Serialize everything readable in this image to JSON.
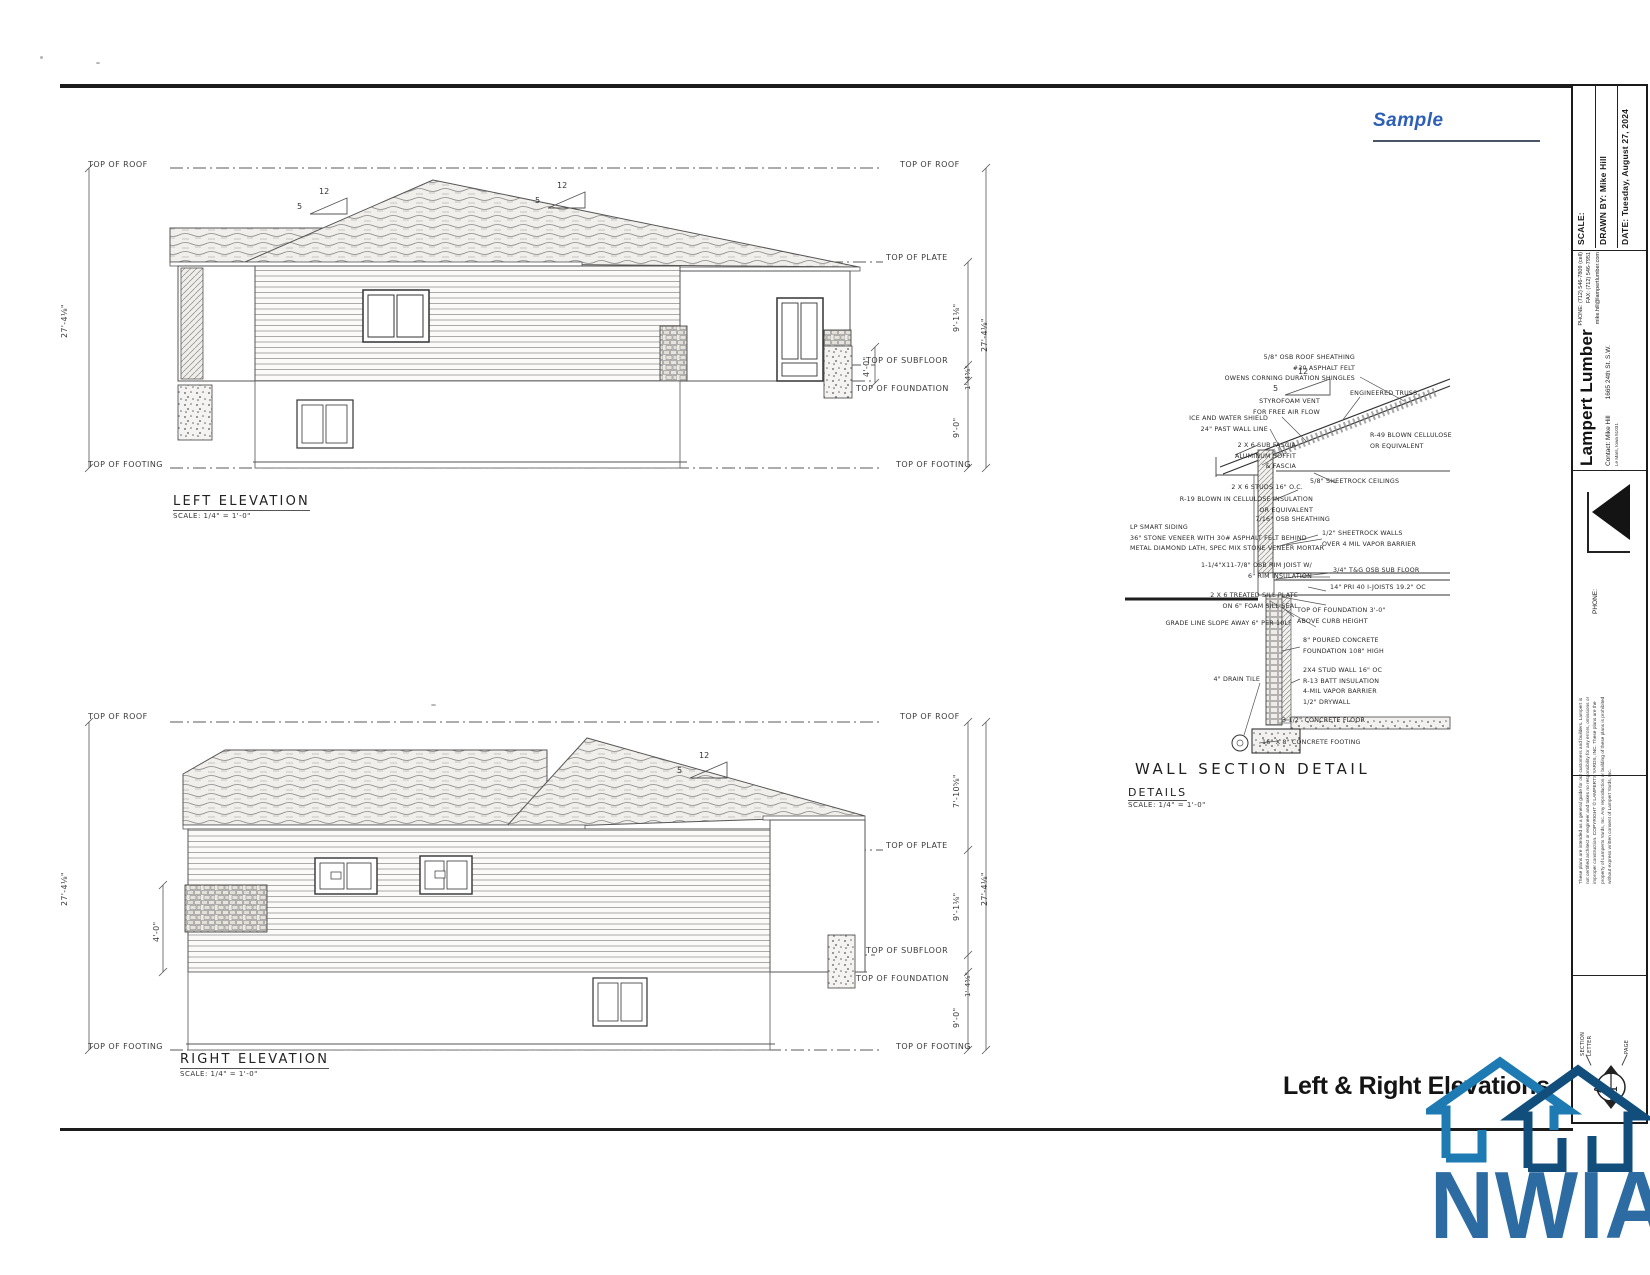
{
  "page": {
    "sample": "Sample",
    "sheet_title": "Left & Right Elevations",
    "logo_text": "NWIA"
  },
  "colors": {
    "sample_blue": "#2e5fb7",
    "logo_light_blue": "#1d7ab3",
    "logo_dark_blue": "#114e7b",
    "logo_text_blue": "#2d6ca3"
  },
  "levels": {
    "roof": "TOP OF ROOF",
    "plate": "TOP OF PLATE",
    "subfloor": "TOP OF SUBFLOOR",
    "foundation": "TOP OF FOUNDATION",
    "footing": "TOP OF FOOTING"
  },
  "pitch": {
    "run": "12",
    "rise": "5"
  },
  "left_elevation": {
    "title": "LEFT ELEVATION",
    "scale": "SCALE: 1/4\" = 1'-0\"",
    "dims": {
      "overall": "27'-4⅛\"",
      "upper": "9'-1⅛\"",
      "rim": "1'-4⅝\"",
      "lower": "9'-0\"",
      "small": "4'-0\""
    }
  },
  "right_elevation": {
    "title": "RIGHT ELEVATION",
    "scale": "SCALE: 1/4\" = 1'-0\"",
    "dims": {
      "overall": "27'-4⅛\"",
      "roof": "7'-10⅝\"",
      "upper": "9'-1⅛\"",
      "rim": "1'-4⅝\"",
      "lower": "9'-0\"",
      "stone": "4'-0\""
    }
  },
  "wall_section": {
    "title": "WALL SECTION DETAIL",
    "subtitle": "DETAILS",
    "scale": "SCALE: 1/4\" = 1'-0\"",
    "left": [
      {
        "text": "5/8\" OSB ROOF SHEATHING\n#30 ASPHALT FELT\nOWENS CORNING DURATION SHINGLES"
      },
      {
        "text": "STYROFOAM VENT\nFOR FREE AIR FLOW"
      },
      {
        "text": "ICE AND WATER SHIELD\n24\" PAST WALL LINE"
      },
      {
        "text": "2 X 6 SUB FASCIA\nALUMINUM SOFFIT\n& FASCIA"
      },
      {
        "text": "2 X 6 STUDS 16\" O.C."
      },
      {
        "text": "R-19 BLOWN IN CELLULOSE INSULATION\nOR EQUIVALENT"
      },
      {
        "text": "7/16\" OSB SHEATHING"
      },
      {
        "text": "LP SMART SIDING\n36\" STONE VENEER WITH 30# ASPHALT FELT BEHIND\nMETAL DIAMOND LATH, SPEC MIX STONE VENEER MORTAR"
      },
      {
        "text": "1-1/4\"X11-7/8\" OSB RIM JOIST W/\n6\" RIM INSULATION"
      },
      {
        "text": "2 X 6 TREATED SILL PLATE\nON 6\" FOAM SILL SEAL"
      },
      {
        "text": "GRADE LINE SLOPE AWAY 6\" PER 10LF"
      },
      {
        "text": "4\" DRAIN TILE"
      }
    ],
    "right": [
      {
        "text": "ENGINEERED TRUSS"
      },
      {
        "text": "R-49 BLOWN CELLULOSE\nOR EQUIVALENT"
      },
      {
        "text": "5/8\" SHEETROCK CEILINGS"
      },
      {
        "text": "1/2\" SHEETROCK WALLS\nOVER 4 MIL VAPOR BARRIER"
      },
      {
        "text": "3/4\" T&G OSB SUB FLOOR"
      },
      {
        "text": "14\" PRI 40 I-JOISTS 19.2\" OC"
      },
      {
        "text": "TOP OF FOUNDATION 3'-0\"\nABOVE CURB HEIGHT"
      },
      {
        "text": "8\" POURED CONCRETE\nFOUNDATION 108\" HIGH"
      },
      {
        "text": "2X4 STUD WALL 16\" OC\nR-13 BATT INSULATION\n4-MIL VAPOR BARRIER\n1/2\" DRYWALL"
      },
      {
        "text": "3 1/2\" CONCRETE FLOOR"
      },
      {
        "text": "16\" X 8\" CONCRETE FOOTING"
      }
    ]
  },
  "title_block": {
    "scale_label": "SCALE:",
    "drawn_by": "DRAWN BY:  Mike Hill",
    "date": "DATE:  Tuesday, August 27, 2024",
    "company": "Lampert Lumber",
    "contact": "Contact: Mike Hill",
    "phone": "PHONE: (712) 546-7809 (cell)",
    "fax": "FAX: (712) 546-7951",
    "email": "mike.hill@lampertlumber.com",
    "address": "1665 24th St. S.W.",
    "city": "Le Mars, Iowa 51031",
    "phone_label": "PHONE:",
    "disclaimer": "These plans are intended as a general guide for our customers and builders. Lampert is not certified architect or engineer and takes no responsibility for any errors, omissions or improper construction. COPYRIGHT © LAMPERTS YARDS, INC. These plans are the property of Lamperts Yards, Inc. Any reproduction or building of these plans is prohibited without express written consent of Lampert Yards, Inc.",
    "section_letter_label": "SECTION\nLETTER",
    "page_label": "PAGE",
    "section_letter": "A",
    "page_number": "1"
  }
}
